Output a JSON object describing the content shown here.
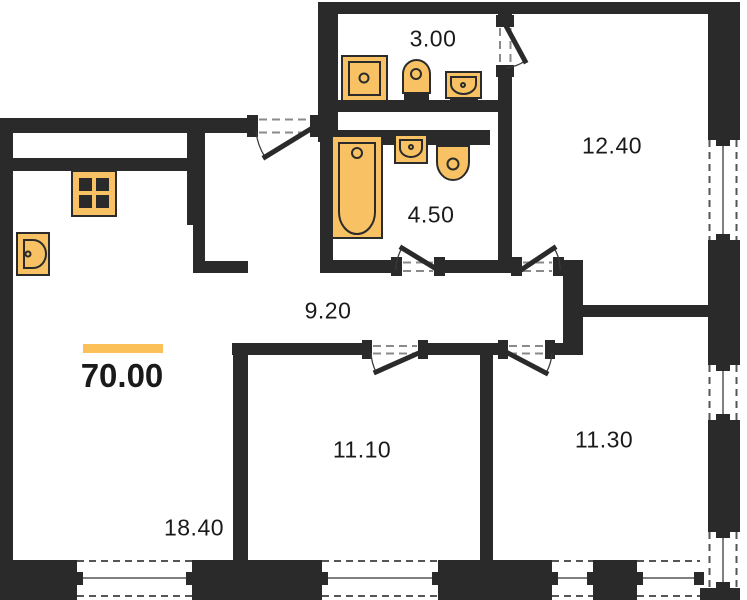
{
  "plan": {
    "title": "apartment-floor-plan",
    "total_area": "70.00",
    "rooms": [
      {
        "id": "wc",
        "area": "3.00"
      },
      {
        "id": "bathroom",
        "area": "4.50"
      },
      {
        "id": "room-top-right",
        "area": "12.40"
      },
      {
        "id": "hallway",
        "area": "9.20"
      },
      {
        "id": "living-kitchen",
        "area": "18.40"
      },
      {
        "id": "room-bottom-middle",
        "area": "11.10"
      },
      {
        "id": "room-bottom-right",
        "area": "11.30"
      }
    ],
    "fixtures": [
      "stove-icon",
      "kitchen-sink-icon",
      "washing-machine-icon",
      "toilet-icon",
      "hand-basin-icon",
      "bathtub-icon"
    ],
    "counts": {
      "windows": 7,
      "doors": 6
    },
    "colors": {
      "wall": "#2a2a2a",
      "fixture_fill": "#f8c264",
      "fixture_stroke": "#2b2b2b",
      "accent_bar": "#fbc158",
      "window_line": "#555555",
      "door_dash": "#8a8a8a",
      "background": "#ffffff",
      "label": "#1a1a1a"
    }
  }
}
